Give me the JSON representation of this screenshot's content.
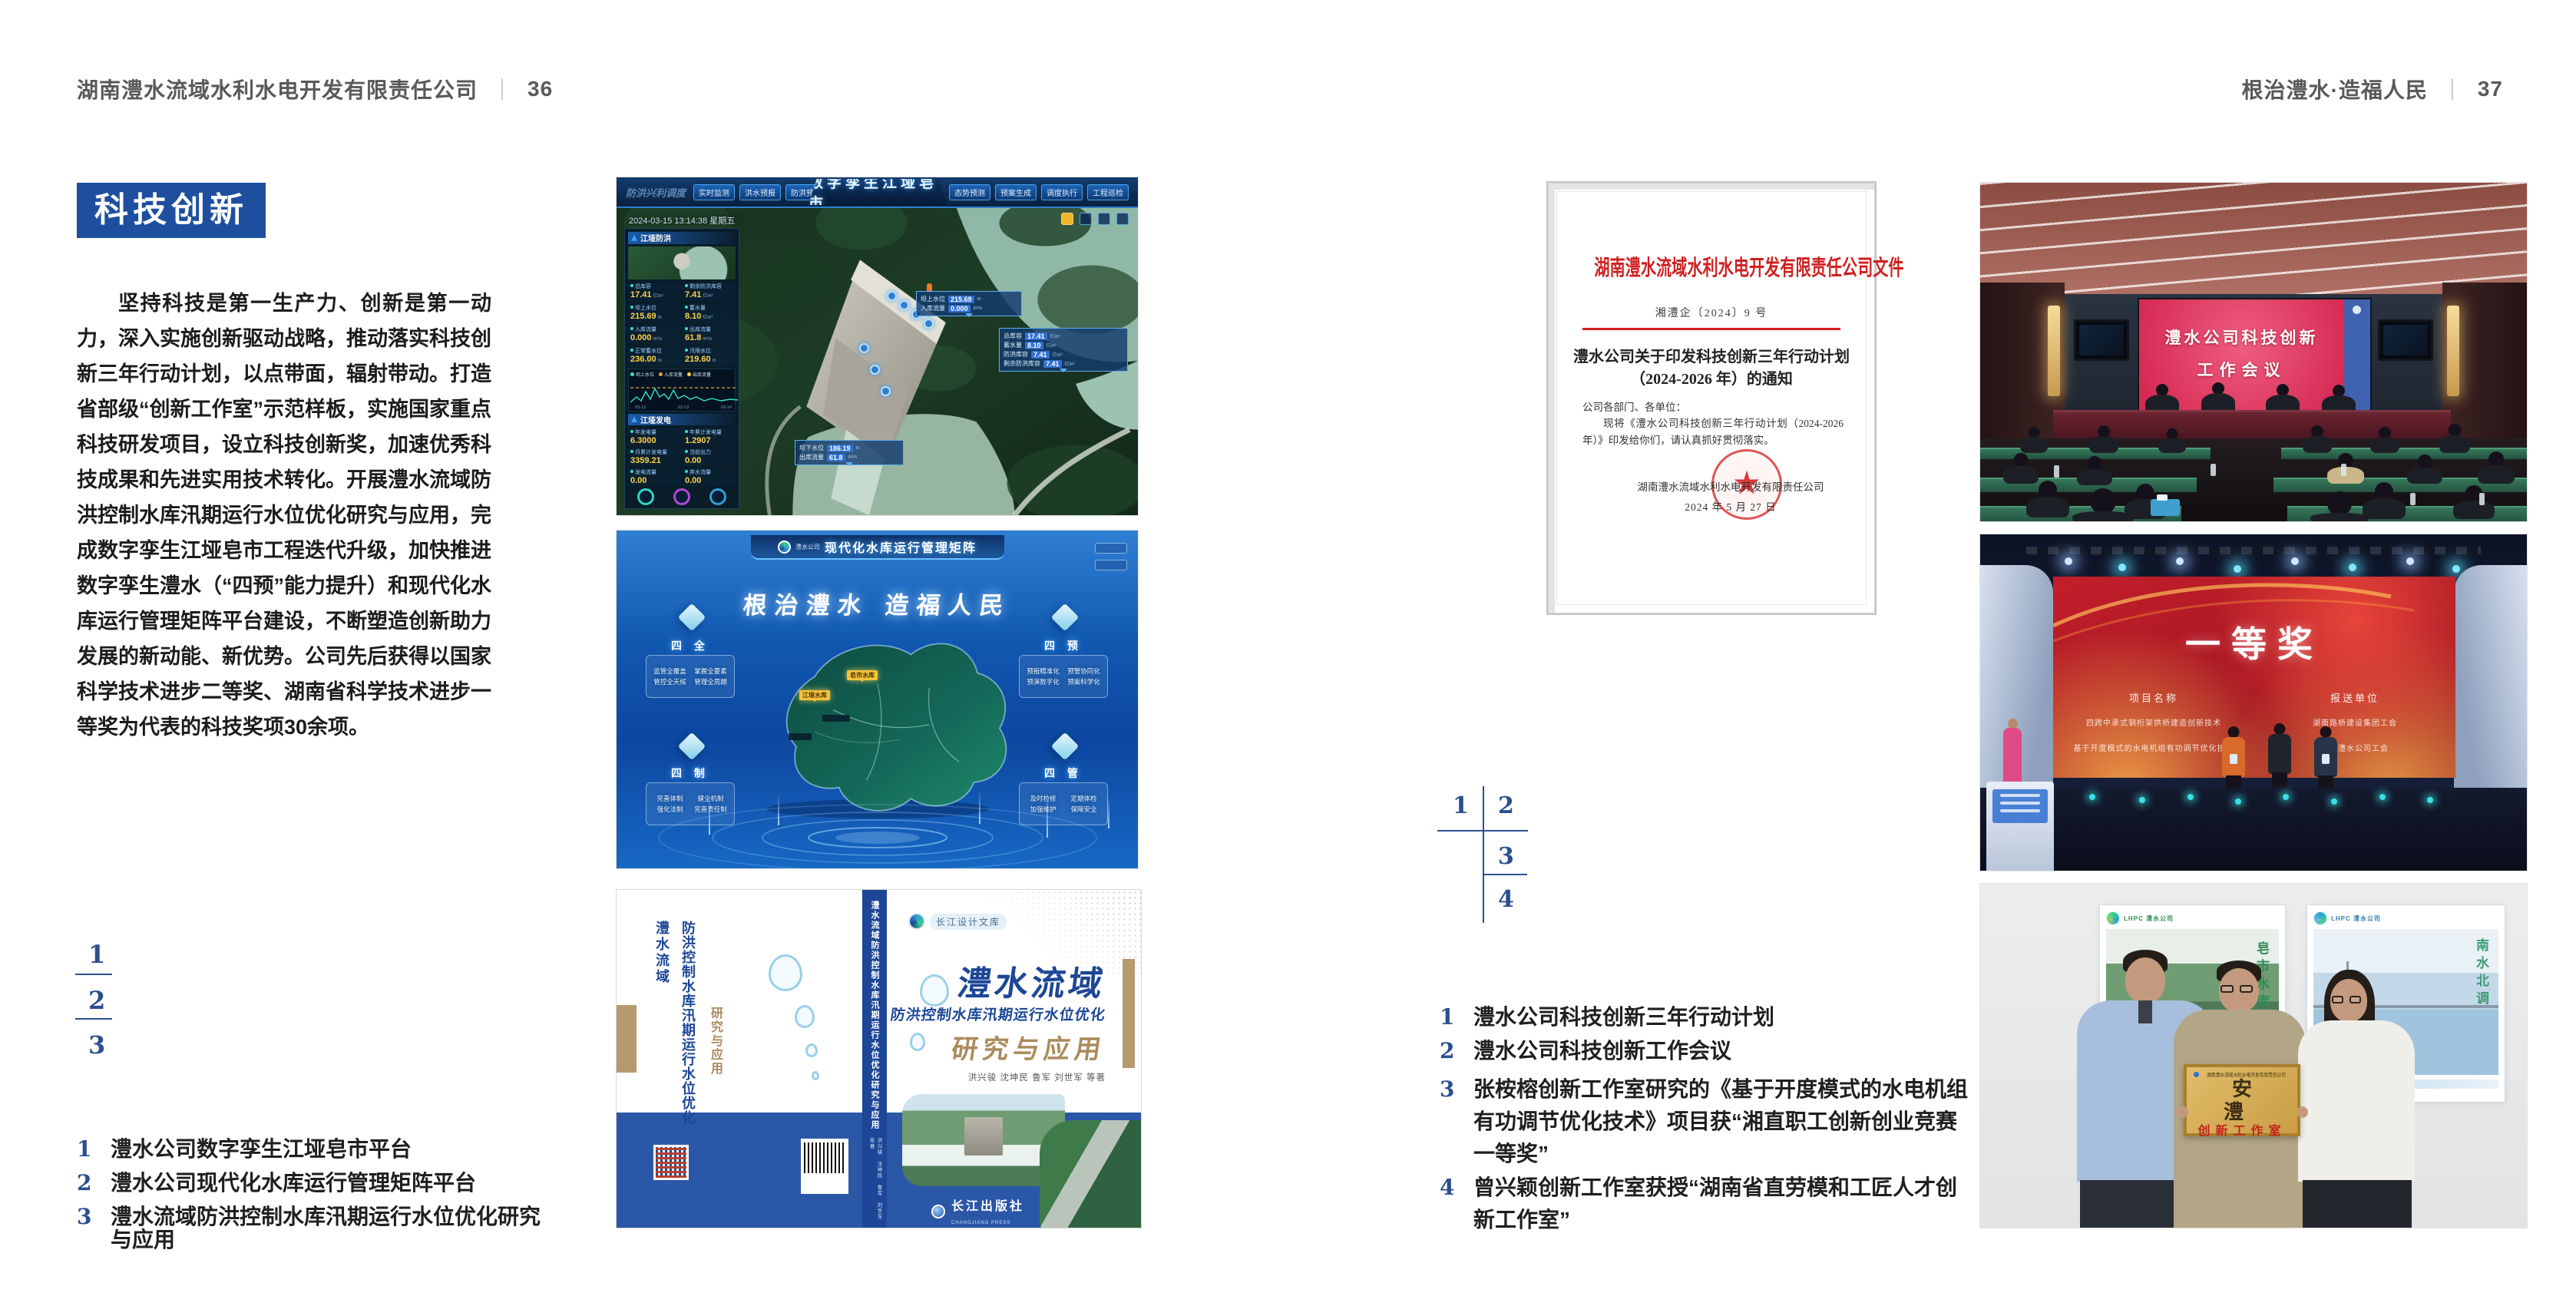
{
  "header": {
    "left_company": "湖南澧水流域水利水电开发有限责任公司",
    "left_page_no": "36",
    "right_slogan": "根治澧水·造福人民",
    "right_page_no": "37",
    "separator": "｜"
  },
  "left_page": {
    "section_title": "科技创新",
    "body": "坚持科技是第一生产力、创新是第一动力，深入实施创新驱动战略，推动落实科技创新三年行动计划，以点带面，辐射带动。打造省部级“创新工作室”示范样板，实施国家重点科技研发项目，设立科技创新奖，加速优秀科技成果和先进实用技术转化。开展澧水流域防洪控制水库汛期运行水位优化研究与应用，完成数字孪生江垭皂市工程迭代升级，加快推进数字孪生澧水（“四预”能力提升）和现代化水库运行管理矩阵平台建设，不断塑造创新助力发展的新动能、新优势。公司先后获得以国家科学技术进步二等奖、湖南省科学技术进步一等奖为代表的科技奖项30余项。",
    "figure_index": [
      "1",
      "2",
      "3"
    ],
    "captions": [
      {
        "num": "1",
        "text": "澧水公司数字孪生江垭皂市平台"
      },
      {
        "num": "2",
        "text": "澧水公司现代化水库运行管理矩阵平台"
      },
      {
        "num": "3",
        "text": "澧水流域防洪控制水库汛期运行水位优化研究与应用"
      }
    ]
  },
  "right_page": {
    "figure_index": [
      "1",
      "2",
      "3",
      "4"
    ],
    "captions": [
      {
        "num": "1",
        "text": "澧水公司科技创新三年行动计划"
      },
      {
        "num": "2",
        "text": "澧水公司科技创新工作会议"
      },
      {
        "num": "3",
        "text": "张桉榕创新工作室研究的《基于开度模式的水电机组有功调节优化技术》项目获“湘直职工创新创业竞赛一等奖”"
      },
      {
        "num": "4",
        "text": "曾兴颖创新工作室获授“湖南省直劳模和工匠人才创新工作室”"
      }
    ]
  },
  "fig_dashboard": {
    "title": "数字孪生江垭皂市",
    "corner_label": "防洪兴利调度",
    "tabs_left": [
      "实时监测",
      "洪水预报",
      "防洪预警"
    ],
    "tabs_right": [
      "态势预测",
      "预案生成",
      "调度执行",
      "工程巡检"
    ],
    "datetime": "2024-03-15 13:14:38 星期五",
    "panel_flood": {
      "title": "江垭防洪",
      "stats": [
        {
          "label": "总库容",
          "value": "17.41",
          "unit": "亿m³"
        },
        {
          "label": "剩余防洪库容",
          "value": "7.41",
          "unit": "亿m³"
        },
        {
          "label": "坝上水位",
          "value": "215.69",
          "unit": "m"
        },
        {
          "label": "蓄水量",
          "value": "8.10",
          "unit": "亿m³"
        },
        {
          "label": "入库流量",
          "value": "0.000",
          "unit": "m³/s"
        },
        {
          "label": "出库流量",
          "value": "61.8",
          "unit": "m³/s"
        },
        {
          "label": "正常蓄水位",
          "value": "236.00",
          "unit": "m"
        },
        {
          "label": "汛限水位",
          "value": "219.60",
          "unit": "m"
        }
      ]
    },
    "chart": {
      "legend": [
        "坝上水位",
        "入库流量",
        "出库流量"
      ],
      "ticks": [
        "03-12",
        "03-13",
        "03-14"
      ]
    },
    "panel_power": {
      "title": "江垭发电",
      "stats": [
        {
          "label": "年发电量",
          "value": "6.3000"
        },
        {
          "label": "年累计发电量",
          "value": "1.2907"
        },
        {
          "label": "月累计发电量",
          "value": "3359.21"
        },
        {
          "label": "当前出力",
          "value": "0.00"
        },
        {
          "label": "发电流量",
          "value": "0.00"
        },
        {
          "label": "弃水流量",
          "value": "0.00"
        }
      ]
    },
    "callout_up": {
      "rows": [
        {
          "label": "坝上水位",
          "value": "215.69",
          "unit": "m"
        },
        {
          "label": "入库流量",
          "value": "0.000",
          "unit": "m³/s"
        }
      ]
    },
    "callout_storage": {
      "rows": [
        {
          "label": "总库容",
          "value": "17.41",
          "unit": "亿m³"
        },
        {
          "label": "蓄水量",
          "value": "8.10",
          "unit": "亿m³"
        },
        {
          "label": "防洪库容",
          "value": "7.41",
          "unit": "亿m³"
        },
        {
          "label": "剩余防洪库容",
          "value": "7.41",
          "unit": "亿m³"
        }
      ]
    },
    "callout_down": {
      "rows": [
        {
          "label": "坝下水位",
          "value": "186.19",
          "unit": "m"
        },
        {
          "label": "出库流量",
          "value": "61.8",
          "unit": "m³/s"
        }
      ]
    }
  },
  "fig_matrix": {
    "logo_text": "澧水公司",
    "title": "现代化水库运行管理矩阵",
    "slogan": "根治澧水 造福人民",
    "panels": [
      {
        "name": "四 全",
        "items": [
          "监管全覆盖",
          "掌握全要素",
          "管控全天候",
          "管理全周期"
        ]
      },
      {
        "name": "四 预",
        "items": [
          "预报精准化",
          "预警协同化",
          "预演数字化",
          "预案科学化"
        ]
      },
      {
        "name": "四 制",
        "items": [
          "完善体制",
          "健全机制",
          "强化法制",
          "完善责任制"
        ]
      },
      {
        "name": "四 管",
        "items": [
          "及时检修",
          "定期体检",
          "加强维护",
          "保障安全"
        ]
      }
    ],
    "map_labels": [
      "江垭水库",
      "皂市水库"
    ]
  },
  "fig_book": {
    "series_badge": "长江设计文库",
    "title_region": "澧水流域",
    "title_sub": "防洪控制水库汛期运行水位优化",
    "title_tail": "研究与应用",
    "authors": "洪兴骏  沈坤民  鲁军  刘世军  等著",
    "spine_title": "澧水流域防洪控制水库汛期运行水位优化研究与应用",
    "publisher": "长江出版社",
    "publisher_en": "CHANGJIANG PRESS"
  },
  "fig_document": {
    "header": "湖南澧水流域水利水电开发有限责任公司文件",
    "doc_no": "湘澧企〔2024〕9 号",
    "title_line1": "澧水公司关于印发科技创新三年行动计划",
    "title_line2": "（2024-2026 年）的通知",
    "salutation": "公司各部门、各单位：",
    "body": "现将《澧水公司科技创新三年行动计划（2024-2026 年）》印发给你们，请认真抓好贯彻落实。",
    "signer": "湖南澧水流域水利水电开发有限责任公司",
    "date": "2024 年 5 月 27 日"
  },
  "fig_meeting": {
    "screen_line1": "澧水公司科技创新",
    "screen_line2": "工作会议"
  },
  "fig_award": {
    "screen_title": "一等奖",
    "col_project": "项目名称",
    "col_org": "报送单位",
    "rows": [
      {
        "project": "四跨中承式钢桁架拱桥建造创新技术",
        "org": "湖南路桥建设集团工会"
      },
      {
        "project": "基于开度模式的水电机组有功调节优化技术",
        "org": "湖南澧水公司工会"
      }
    ]
  },
  "fig_group": {
    "plaque_header": "湖南澧水流域水利水电开发有限责任公司",
    "plaque_title": "安 澧",
    "plaque_subtitle": "创新工作室",
    "poster_left_caption": "皂市水库",
    "poster_right_caption": "南水北调",
    "poster_logo": "LHPC 澧水公司"
  },
  "colors": {
    "accent_blue": "#1d4f9e",
    "index_blue": "#2a4f8f",
    "doc_red": "#d01f1f",
    "text_dark": "#231f20"
  }
}
